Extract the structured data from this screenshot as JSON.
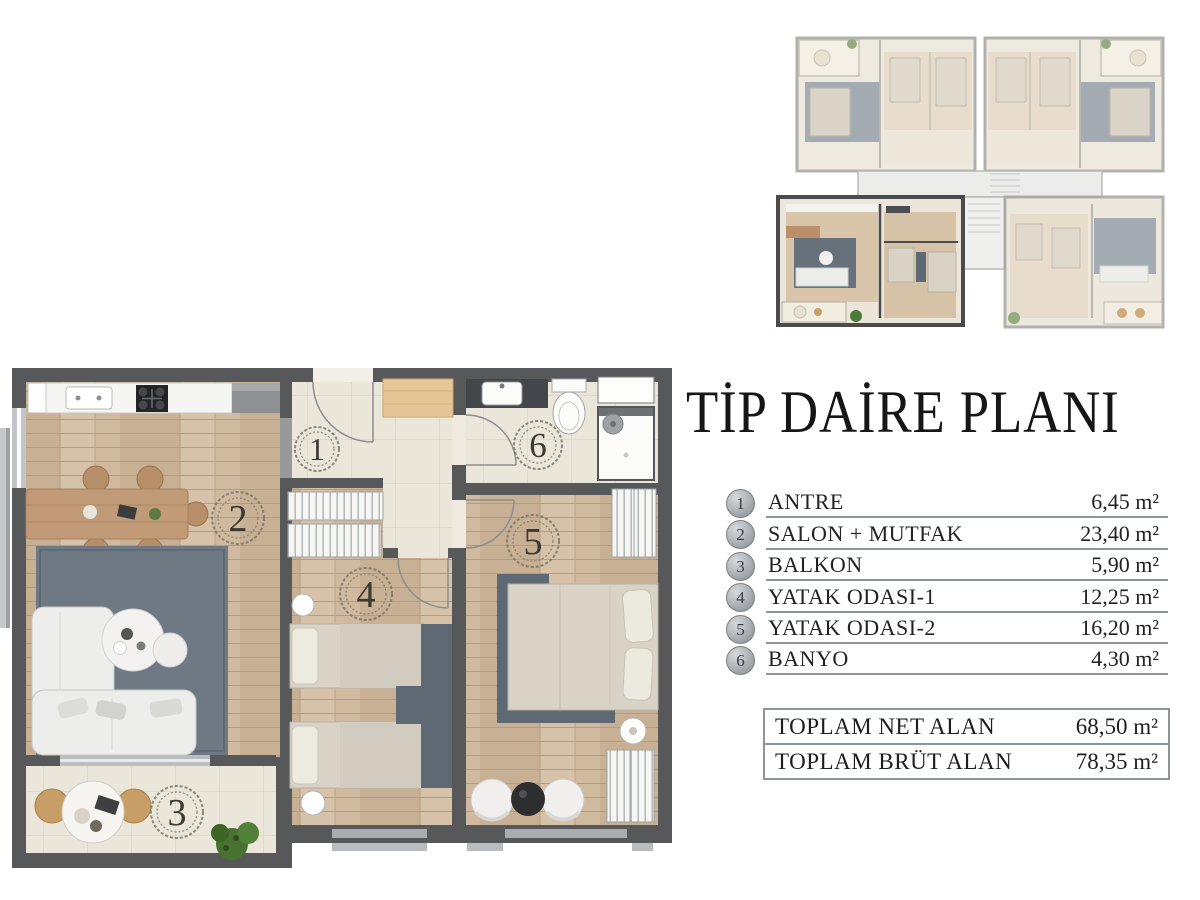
{
  "title": "TİP DAİRE PLANI",
  "legend": {
    "rooms": [
      {
        "number": "1",
        "name": "ANTRE",
        "area": "6,45 m²"
      },
      {
        "number": "2",
        "name": "SALON + MUTFAK",
        "area": "23,40 m²"
      },
      {
        "number": "3",
        "name": "BALKON",
        "area": "5,90 m²"
      },
      {
        "number": "4",
        "name": "YATAK ODASI-1",
        "area": "12,25 m²"
      },
      {
        "number": "5",
        "name": "YATAK ODASI-2",
        "area": "16,20 m²"
      },
      {
        "number": "6",
        "name": "BANYO",
        "area": "4,30 m²"
      }
    ],
    "totals": [
      {
        "label": "TOPLAM NET ALAN",
        "value": "68,50 m²"
      },
      {
        "label": "TOPLAM BRÜT ALAN",
        "value": "78,35 m²"
      }
    ]
  },
  "colors": {
    "wall": "#57585a",
    "wood_floor": "#cfbaa0",
    "tile_floor": "#ebe6da",
    "rug_slate": "#6e7983",
    "rug_dark": "#5f6973",
    "plant_green": "#47722f",
    "badge_gray": "#9ea4a7"
  }
}
